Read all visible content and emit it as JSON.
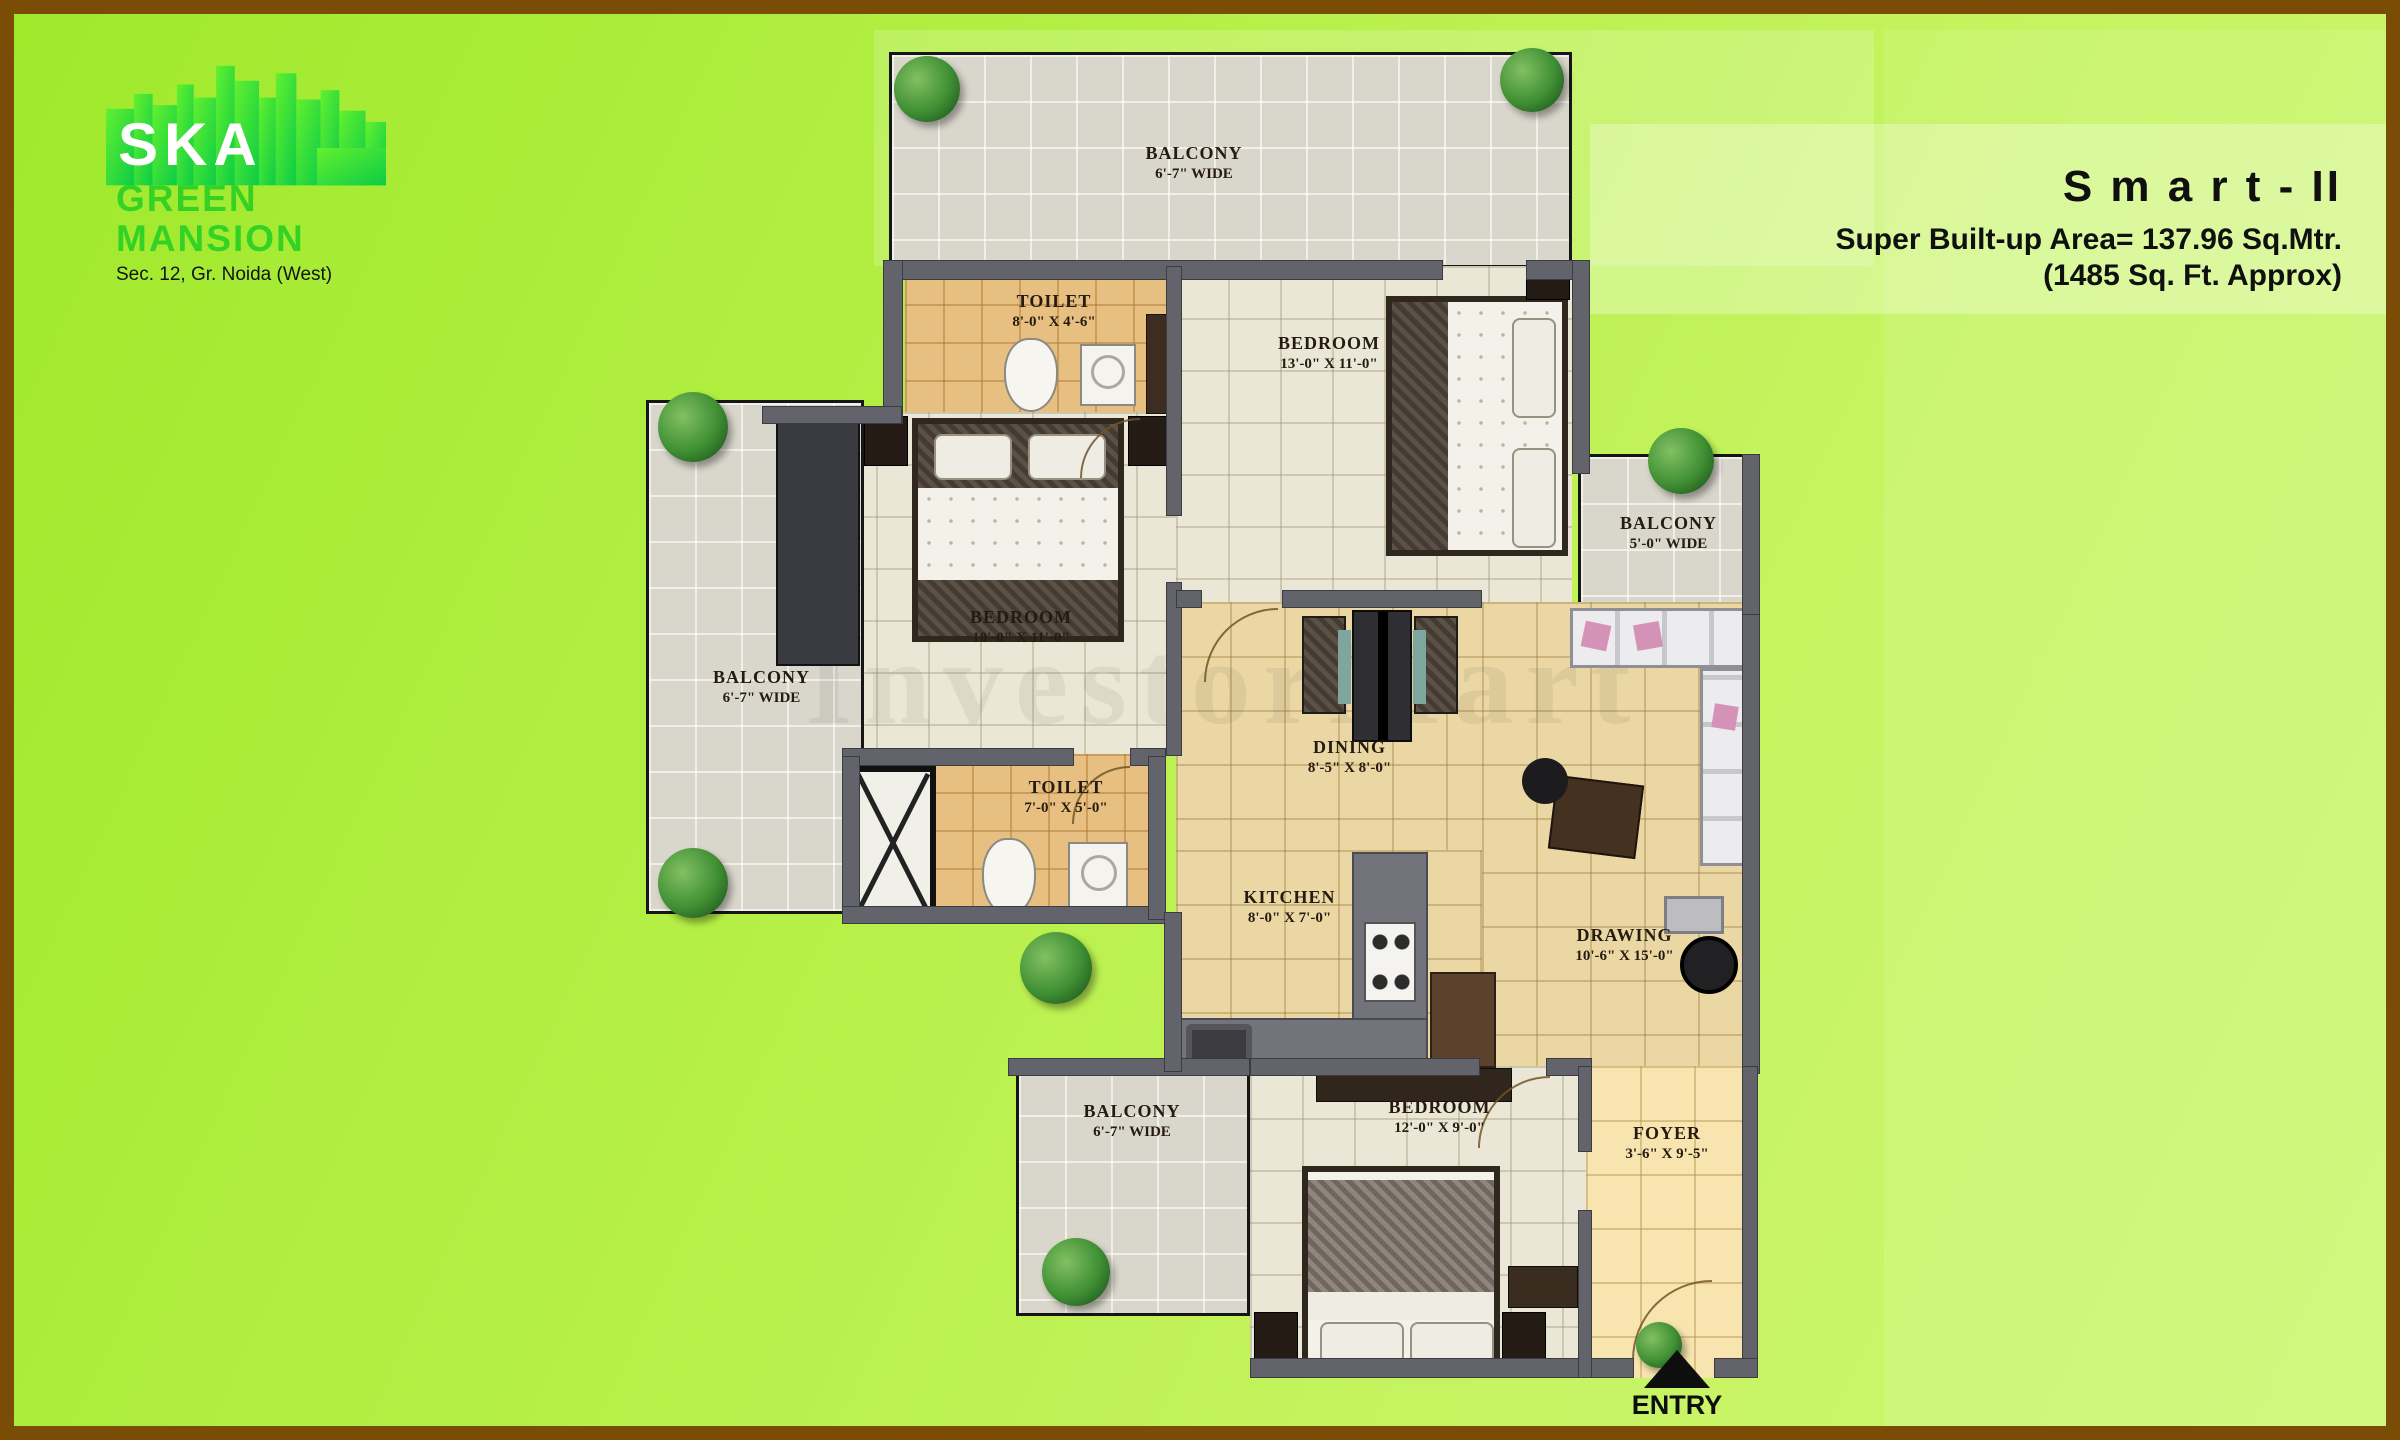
{
  "logo": {
    "brand": "SKA",
    "line1": "GREEN",
    "line2": "MANSION",
    "subtitle": "Sec. 12, Gr. Noida (West)"
  },
  "plan_title": {
    "name": "S m a r t - II",
    "area1": "Super Built-up Area= 137.96 Sq.Mtr.",
    "area2": "(1485 Sq. Ft. Approx)"
  },
  "watermark": "InvestorMart",
  "entry_label": "ENTRY",
  "rooms": [
    {
      "id": "balcony-top",
      "name": "BALCONY",
      "dims": "6'-7\" WIDE"
    },
    {
      "id": "toilet-top",
      "name": "TOILET",
      "dims": "8'-0\" X 4'-6\""
    },
    {
      "id": "bedroom-top",
      "name": "BEDROOM",
      "dims": "13'-0\" X 11'-0\""
    },
    {
      "id": "balcony-right",
      "name": "BALCONY",
      "dims": "5'-0\" WIDE"
    },
    {
      "id": "bedroom-mid",
      "name": "BEDROOM",
      "dims": "10'-0\" X 11'-0\""
    },
    {
      "id": "balcony-left",
      "name": "BALCONY",
      "dims": "6'-7\" WIDE"
    },
    {
      "id": "toilet-mid",
      "name": "TOILET",
      "dims": "7'-0\" X 5'-0\""
    },
    {
      "id": "dining",
      "name": "DINING",
      "dims": "8'-5\" X 8'-0\""
    },
    {
      "id": "kitchen",
      "name": "KITCHEN",
      "dims": "8'-0\" X 7'-0\""
    },
    {
      "id": "drawing",
      "name": "DRAWING",
      "dims": "10'-6\" X 15'-0\""
    },
    {
      "id": "balcony-bottom",
      "name": "BALCONY",
      "dims": "6'-7\" WIDE"
    },
    {
      "id": "bedroom-bottom",
      "name": "BEDROOM",
      "dims": "12'-0\" X 9'-0\""
    },
    {
      "id": "foyer",
      "name": "FOYER",
      "dims": "3'-6\" X 9'-5\""
    }
  ],
  "colors": {
    "brand_green": "#35d226",
    "frame_brown": "#7b4c06",
    "background_green": "#b5ef46",
    "wall_gray": "#63636b",
    "balcony_floor": "#d9d6cb",
    "bedroom_floor": "#ebe7d6",
    "toilet_floor": "#e7bf80",
    "living_floor": "#ead7a4"
  }
}
